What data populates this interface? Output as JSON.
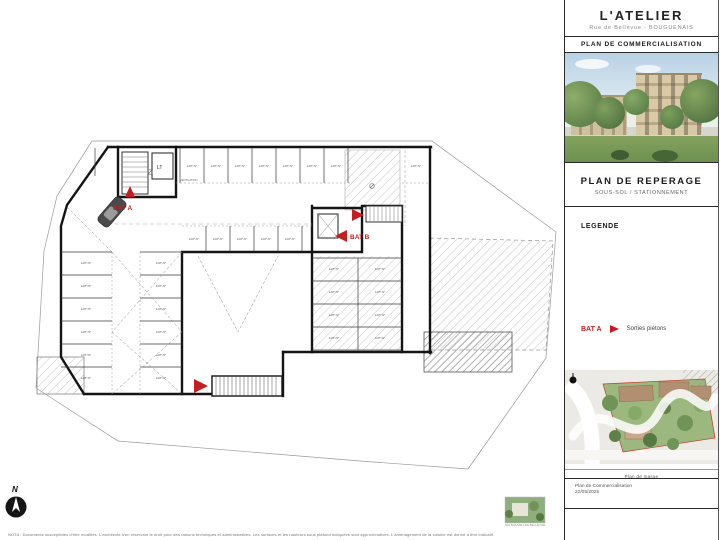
{
  "header": {
    "project_title": "L'ATELIER",
    "project_address": "Rue de Bellevue  -  BOUGUENAIS",
    "doc_bar": "PLAN DE COMMERCIALISATION"
  },
  "plan_panel": {
    "title": "PLAN DE REPERAGE",
    "subtitle": "SOUS-SOL / STATIONNEMENT"
  },
  "legend": {
    "heading": "LEGENDE",
    "entry": {
      "label": "BAT A",
      "symbol": "arrow-right",
      "description": "Sorties piétons"
    }
  },
  "site_map": {
    "caption": "Plan de masse"
  },
  "footer_box": {
    "line1": "Plan de Commercialisation",
    "line2": "22/05/2025"
  },
  "plan": {
    "labels": {
      "bat_a": "BAT A",
      "bat_b": "BAT B",
      "elevator": "LT",
      "ventilation": "VENTILATION",
      "north": "N",
      "lot": "LOT N°"
    },
    "lot_groups": [
      {
        "id": "top-row",
        "count": 8
      },
      {
        "id": "mid-row",
        "count": 5
      },
      {
        "id": "left-column",
        "count": 6
      },
      {
        "id": "center-column",
        "count": 6
      },
      {
        "id": "right-wing-left",
        "count": 4
      },
      {
        "id": "right-wing-right",
        "count": 4
      }
    ]
  },
  "branding": {
    "logo_caption": "SCI NOUVELLES BELLEVUE"
  },
  "nota": "NOTA : Documents susceptibles d'être modifiés. L'architecte s'en réservant le droit pour des raisons techniques et administratives. Les surfaces et les hauteurs sous plafond indiquées sont approximatives. L'aménagement de la cuisine est donné à titre indicatif.",
  "colors": {
    "accent_red": "#c41e22"
  }
}
